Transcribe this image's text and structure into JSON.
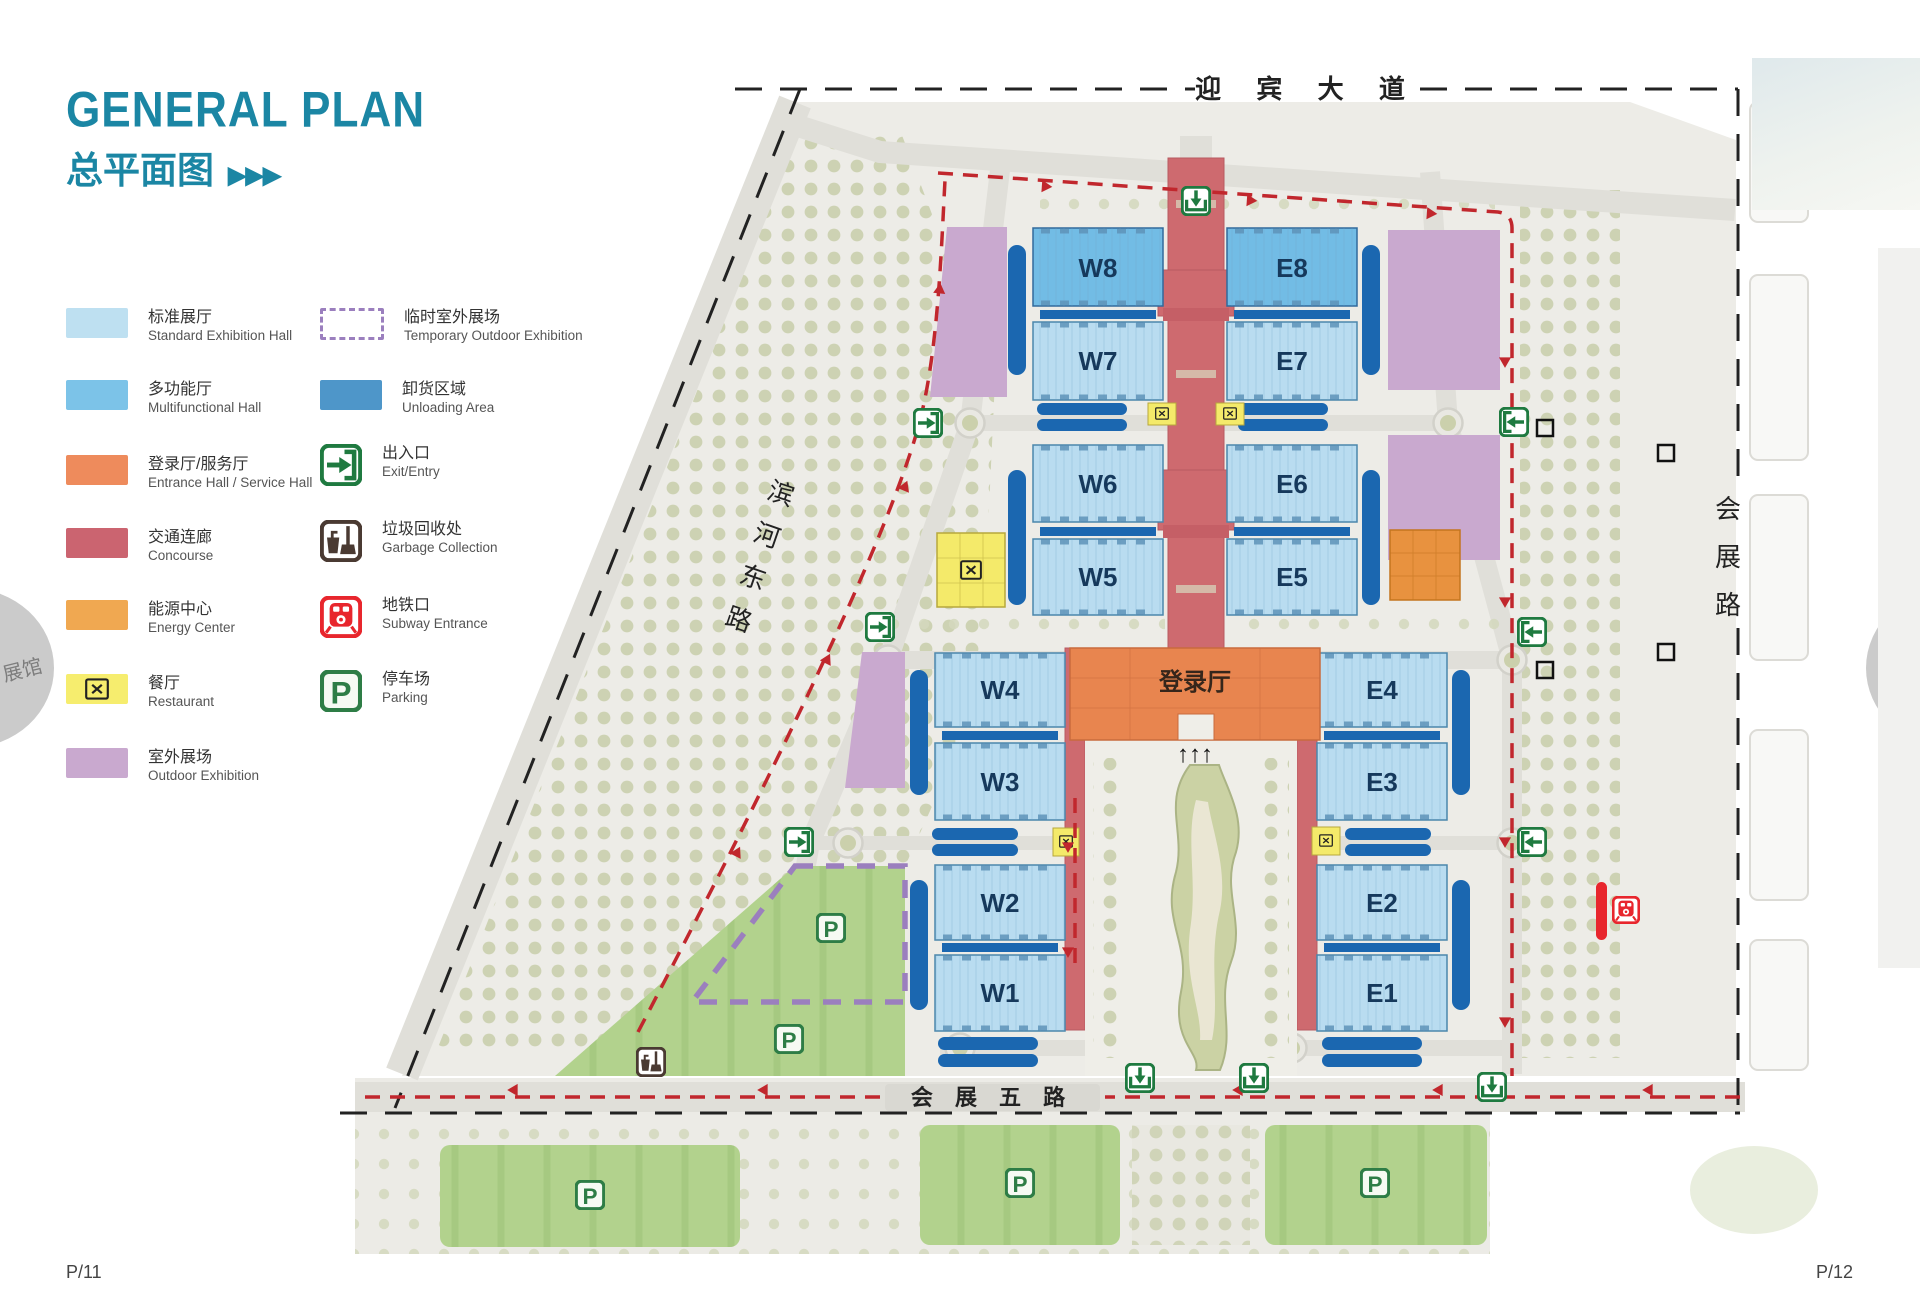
{
  "header": {
    "title": "GENERAL PLAN",
    "subtitle": "总平面图",
    "arrows": "▶▶▶"
  },
  "page": {
    "left_page_number": "P/11",
    "right_page_number": "P/12",
    "side_tab_label": "展馆"
  },
  "legend": {
    "items_left": [
      {
        "zh": "标准展厅",
        "en": "Standard Exhibition Hall",
        "color": "#bee0f1"
      },
      {
        "zh": "多功能厅",
        "en": "Multifunctional Hall",
        "color": "#7cc3e8"
      },
      {
        "zh": "登录厅/服务厅",
        "en": "Entrance Hall / Service Hall",
        "color": "#ee8b5c"
      },
      {
        "zh": "交通连廊",
        "en": "Concourse",
        "color": "#cb6470"
      },
      {
        "zh": "能源中心",
        "en": "Energy Center",
        "color": "#f0a851"
      },
      {
        "zh": "餐厅",
        "en": "Restaurant",
        "color": "#f6ed6e"
      },
      {
        "zh": "室外展场",
        "en": "Outdoor Exhibition",
        "color": "#c9a9cf"
      }
    ],
    "items_right": [
      {
        "zh": "临时室外展场",
        "en": "Temporary Outdoor Exhibition",
        "color": "#9b7fbe",
        "style": "dashed-outline"
      },
      {
        "zh": "卸货区域",
        "en": "Unloading Area",
        "color": "#4e96c9"
      },
      {
        "zh": "出入口",
        "en": "Exit/Entry",
        "icon": "entry-icon",
        "color": "#1f7a40"
      },
      {
        "zh": "垃圾回收处",
        "en": "Garbage Collection",
        "icon": "garbage-icon",
        "color": "#4a3a32"
      },
      {
        "zh": "地铁口",
        "en": "Subway Entrance",
        "icon": "subway-icon",
        "color": "#e8262d"
      },
      {
        "zh": "停车场",
        "en": "Parking",
        "icon": "parking-icon",
        "color": "#2e7d46"
      }
    ]
  },
  "map": {
    "roads": {
      "top": "迎  宾  大  道",
      "bottom": "会 展 五 路",
      "left_chars": [
        "滨",
        "河",
        "东",
        "路"
      ],
      "right_chars": [
        "会",
        "展",
        "路"
      ]
    },
    "halls": {
      "west": [
        "W8",
        "W7",
        "W6",
        "W5",
        "W4",
        "W3",
        "W2",
        "W1"
      ],
      "east": [
        "E8",
        "E7",
        "E6",
        "E5",
        "E4",
        "E3",
        "E2",
        "E1"
      ]
    },
    "entrance_hall_label": "登录厅",
    "entrance_arrows": "↑↑↑",
    "colors": {
      "standard_hall": "#b9dcf0",
      "multifunctional_hall": "#72bce5",
      "entrance_hall": "#e8854f",
      "concourse": "#ce6a6f",
      "energy_center": "#e8923f",
      "restaurant": "#f4ea6a",
      "outdoor_exhibition": "#c9a9cf",
      "temporary_outdoor_dash": "#9b7fbe",
      "unloading": "#1b67b0",
      "parking_green": "#b2d28d",
      "route_red": "#c1272d",
      "boundary_black": "#222222",
      "trees": "#cdd2b3",
      "ground": "#edece7"
    }
  }
}
